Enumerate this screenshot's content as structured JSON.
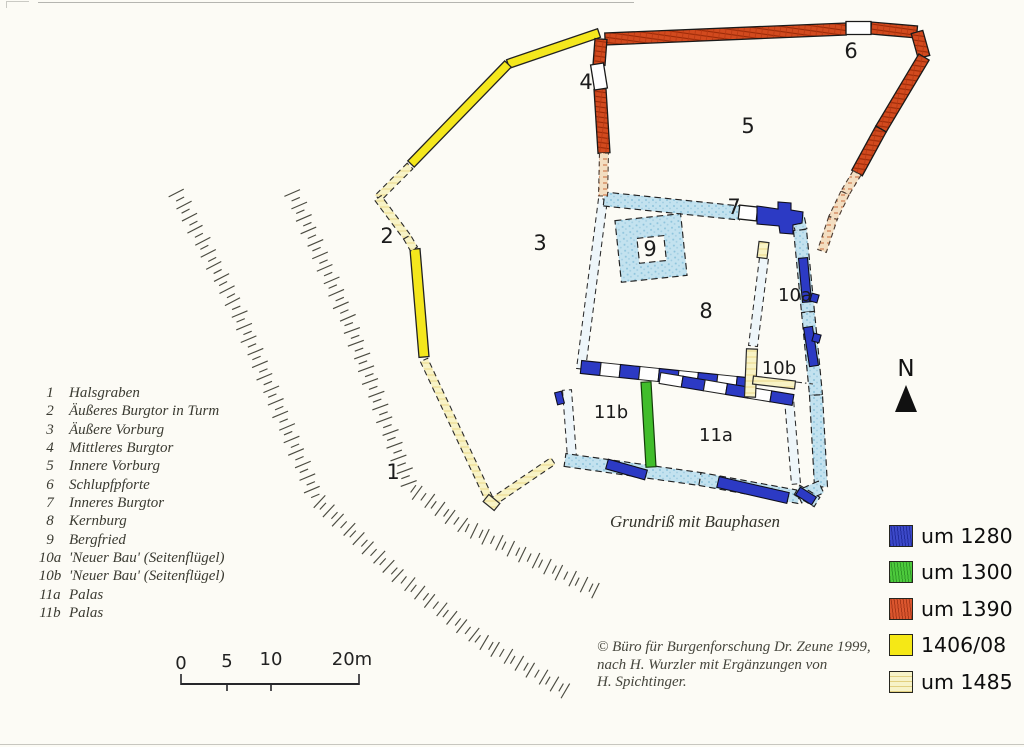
{
  "key": {
    "items": [
      {
        "num": "1",
        "name": "Halsgraben"
      },
      {
        "num": "2",
        "name": "Äußeres Burgtor in Turm"
      },
      {
        "num": "3",
        "name": "Äußere Vorburg"
      },
      {
        "num": "4",
        "name": "Mittleres Burgtor"
      },
      {
        "num": "5",
        "name": "Innere Vorburg"
      },
      {
        "num": "6",
        "name": "Schlupfpforte"
      },
      {
        "num": "7",
        "name": "Inneres Burgtor"
      },
      {
        "num": "8",
        "name": "Kernburg"
      },
      {
        "num": "9",
        "name": "Bergfried"
      },
      {
        "num": "10a",
        "name": "'Neuer Bau' (Seitenflügel)"
      },
      {
        "num": "10b",
        "name": "'Neuer Bau' (Seitenflügel)"
      },
      {
        "num": "11a",
        "name": "Palas"
      },
      {
        "num": "11b",
        "name": "Palas"
      }
    ]
  },
  "plan": {
    "caption": "Grundriß mit Bauphasen",
    "north_label": "N"
  },
  "phase_legend": {
    "items": [
      {
        "label": "um 1280",
        "color": "#2c3ac4"
      },
      {
        "label": "um 1300",
        "color": "#3ec52c"
      },
      {
        "label": "um 1390",
        "color": "#d8481c"
      },
      {
        "label": "1406/08",
        "color": "#f5e816"
      },
      {
        "label": "um 1485",
        "color": "#f7f3c8"
      }
    ]
  },
  "scale_bar": {
    "ticks": [
      "0",
      "5",
      "10",
      "20m"
    ]
  },
  "credit": {
    "lines": [
      "© Büro für Burgenforschung Dr. Zeune 1999,",
      "nach H. Wurzler mit Ergänzungen von",
      "H. Spichtinger."
    ]
  }
}
